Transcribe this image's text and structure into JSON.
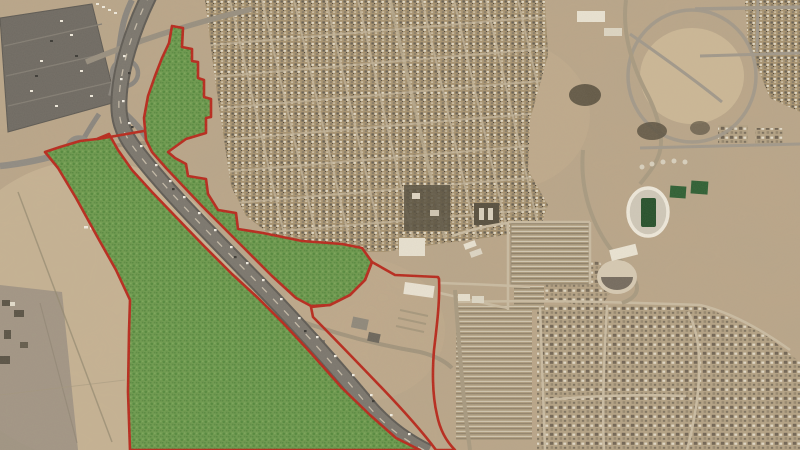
{
  "map": {
    "view": {
      "width": 800,
      "height": 450
    },
    "palette": {
      "desert": "#bba688",
      "urban_block": "#a7926f",
      "road": "#7b766d",
      "highlight_fill": "#4aa233",
      "boundary_red": "#b8291c",
      "stadium_field_green": "#26512b"
    },
    "overlay": {
      "highlight_fill": "#4aa233",
      "highlight_opacity": 0.58,
      "boundary_color": "#b8291c",
      "boundary_width": 2.6,
      "polygons": [
        {
          "name": "east-parcel",
          "filled": true,
          "underlay": true,
          "points": "172,26 183,28 182,47 192,49 192,61 198,62 198,78 204,80 204,97 211,99 211,117 206,118 206,133 186,139 168,152 175,158 186,164 188,176 206,179 208,194 218,210 236,213 238,229 263,233 302,241 342,244 362,248 372,262 365,280 350,295 330,305 311,306 296,298 272,276 248,252 224,228 202,206 183,186 166,168 152,152 146,140 144,118 148,96 155,76 162,58 169,43"
        },
        {
          "name": "west-parcel",
          "filled": true,
          "underlay": true,
          "points": "45,152 60,147 80,141 97,139 109,134 118,150 132,170 152,192 176,217 204,246 232,274 258,298 284,324 310,352 342,388 370,415 396,438 420,450 130,450 128,392 129,332 130,300 116,270 98,238 76,198 58,168"
        },
        {
          "name": "southeast-pocket",
          "filled": false,
          "underlay": false,
          "d": "M372,262 L395,275 L438,277 L439,279 C440,300 437,325 434,350 C432,375 433,398 437,415 C440,430 446,441 455,450 L436,450 C424,434 403,410 380,386 C357,362 332,336 313,317 L311,307 L330,305 L350,295 L365,280 Z"
        }
      ],
      "segments": [
        {
          "name": "highway-crossing",
          "points": "98,139 144,131"
        }
      ]
    }
  }
}
